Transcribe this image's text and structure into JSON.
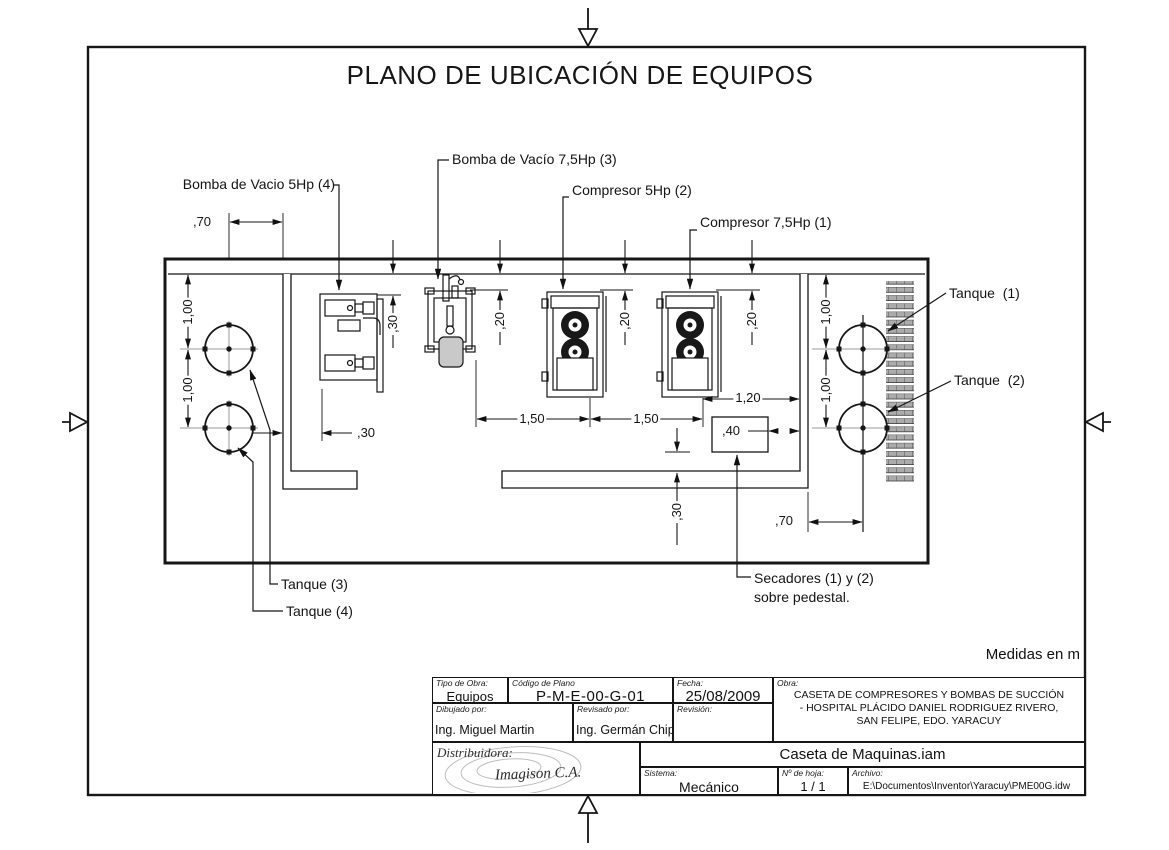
{
  "page": {
    "title": "PLANO DE UBICACIÓN DE EQUIPOS",
    "units_note": "Medidas en m"
  },
  "labels": {
    "bomba_vacio_5hp": "Bomba de Vacio 5Hp (4)",
    "bomba_vacio_7_5hp": "Bomba de Vacío 7,5Hp (3)",
    "compresor_5hp": "Compresor 5Hp (2)",
    "compresor_7_5hp": "Compresor 7,5Hp (1)",
    "tanque_1": "Tanque  (1)",
    "tanque_2": "Tanque  (2)",
    "tanque_3": "Tanque (3)",
    "tanque_4": "Tanque (4)",
    "secadores_line1": "Secadores (1) y (2)",
    "secadores_line2": "sobre pedestal."
  },
  "dims": {
    "left_offset": ",70",
    "left_tank_gap_1": "1,00",
    "left_tank_gap_2": "1,00",
    "wall_gap": ",30",
    "pump4_offset": ",30",
    "pump3_offset": ",20",
    "comp2_offset": ",20",
    "comp1_offset": ",20",
    "spacing_1": "1,50",
    "spacing_2": "1,50",
    "comp1_wall": "1,20",
    "secadores_width": ",40",
    "bottom_gap": ",30",
    "right_offset": ",70",
    "right_tank_gap_1": "1,00",
    "right_tank_gap_2": "1,00"
  },
  "title_block": {
    "tipo_label": "Tipo de Obra:",
    "tipo": "Equipos",
    "codigo_label": "Código de Plano",
    "codigo": "P-M-E-00-G-01",
    "fecha_label": "Fecha:",
    "fecha": "25/08/2009",
    "obra_label": "Obra:",
    "obra_line1": "CASETA DE COMPRESORES Y BOMBAS DE SUCCIÓN",
    "obra_line2": "- HOSPITAL PLÁCIDO DANIEL RODRIGUEZ RIVERO,",
    "obra_line3": "SAN FELIPE, EDO. YARACUY",
    "dibujado_label": "Dibujado por:",
    "dibujado": "Ing. Miguel Martin",
    "revisado_label": "Revisado por:",
    "revisado": "Ing. Germán Chipre",
    "revision_label": "Revisión:",
    "distribuidora_label": "Distribuidora:",
    "distribuidora_name": "Imagison C.A.",
    "assembly_name": "Caseta de Maquinas.iam",
    "sistema_label": "Sistema:",
    "sistema": "Mecánico",
    "hoja_label": "Nº de hoja:",
    "hoja": "1 / 1",
    "archivo_label": "Archivo:",
    "archivo": "E:\\Documentos\\Inventor\\Yaracuy\\PME00G.idw"
  }
}
